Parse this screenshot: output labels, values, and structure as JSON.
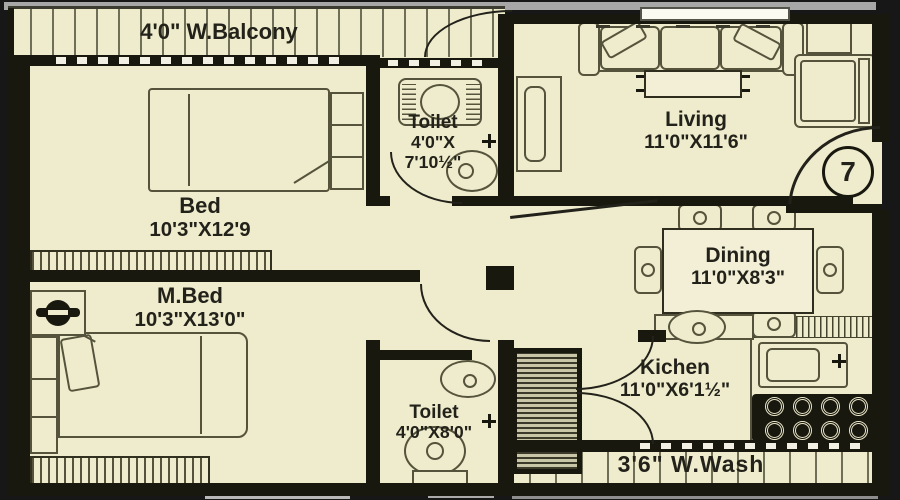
{
  "plan": {
    "unit_number": "7",
    "colors": {
      "floor": "#EFECCD",
      "wall": "#19180F",
      "background": "#171717",
      "line": "#55533C",
      "text": "#23221A",
      "frame": "#A7A7A7",
      "window": "#FAFAF2"
    },
    "rooms": {
      "balcony": {
        "label": "4'0\" W.Balcony"
      },
      "bed": {
        "name": "Bed",
        "dims": "10'3\"X12'9"
      },
      "toilet_top": {
        "name": "Toilet",
        "dims_line1": "4'0\"X",
        "dims_line2": "7'10½\""
      },
      "living": {
        "name": "Living",
        "dims": "11'0\"X11'6\""
      },
      "dining": {
        "name": "Dining",
        "dims": "11'0\"X8'3\""
      },
      "master_bed": {
        "name": "M.Bed",
        "dims": "10'3\"X13'0\""
      },
      "kitchen": {
        "name": "Kichen",
        "dims": "11'0\"X6'1½\""
      },
      "toilet_bottom": {
        "name": "Toilet",
        "dims": "4'0\"X8'0\""
      },
      "wash": {
        "label": "3'6\" W.Wash"
      }
    }
  }
}
